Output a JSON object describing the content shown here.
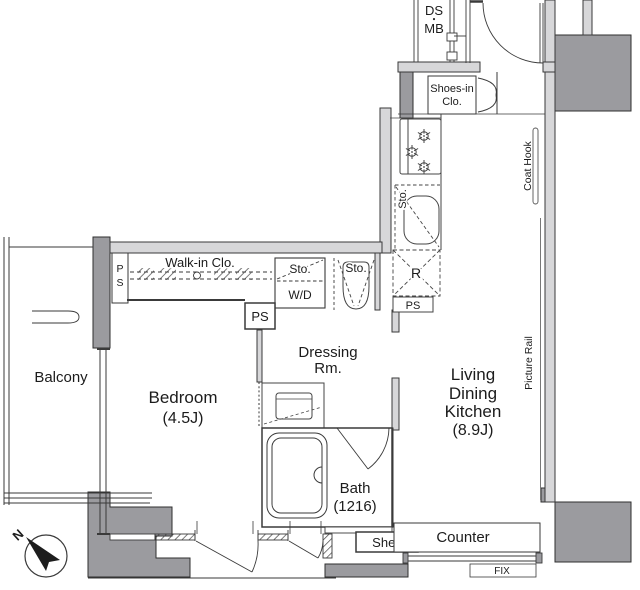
{
  "plan": {
    "rooms": {
      "balcony": "Balcony",
      "bedroom": "Bedroom",
      "bedroom_size": "(4.5J)",
      "dressing_l1": "Dressing",
      "dressing_l2": "Rm.",
      "ldk_l1": "Living",
      "ldk_l2": "Dining",
      "ldk_l3": "Kitchen",
      "ldk_size": "(8.9J)",
      "bath": "Bath",
      "bath_size": "(1216)",
      "walkin": "Walk-in Clo.",
      "shoes_l1": "Shoes-in",
      "shoes_l2": "Clo."
    },
    "labels": {
      "ds": "DS",
      "dot": "・",
      "mb": "MB",
      "sto_kitchen": "Sto.",
      "sto_wd": "Sto.",
      "sto_toilet": "Sto.",
      "wd": "W/D",
      "fridge": "R",
      "ps_walkin_p": "P",
      "ps_walkin_s": "S",
      "ps_mid": "PS",
      "ps_kitchen": "PS",
      "coat_hook": "Coat Hook",
      "picture_rail": "Picture Rail",
      "counter": "Counter",
      "shelf": "Shelf",
      "fix": "FIX",
      "north": "N"
    },
    "colors": {
      "structure_dark": "#9b9b9f",
      "structure_light": "#d7d7d9",
      "line": "#3a3a3a",
      "text": "#1c1c1c",
      "background": "#ffffff"
    }
  }
}
